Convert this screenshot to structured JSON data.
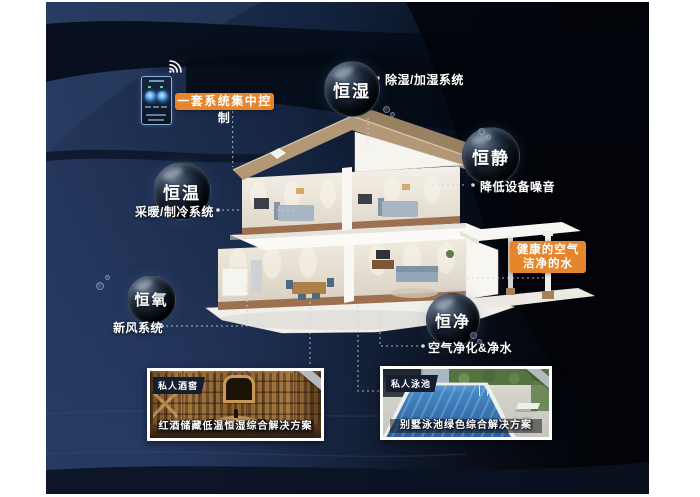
{
  "poster": {
    "control_callout": "一套系统集中控制",
    "healthy_callout": {
      "line1": "健康的空气",
      "line2": "洁净的水"
    },
    "bubbles": [
      {
        "label": "恒湿"
      },
      {
        "label": "恒静"
      },
      {
        "label": "恒温"
      },
      {
        "label": "恒氧"
      },
      {
        "label": "恒净"
      }
    ],
    "system_labels": {
      "humidity": "除湿/加湿系统",
      "noise": "降低设备噪音",
      "hvac": "采暖/制冷系统",
      "fresh_air": "新风系统",
      "purify": "空气净化&净水"
    },
    "photos": [
      {
        "badge": "私人酒窖",
        "caption": "红酒储藏低温恒湿综合解决方案"
      },
      {
        "badge": "私人泳池",
        "caption": "别墅泳池绿色综合解决方案"
      }
    ],
    "colors": {
      "accent_orange": "#e6862c",
      "background_navy": "#22365a",
      "background_black": "#04060c",
      "label_text": "#ffffff"
    }
  }
}
